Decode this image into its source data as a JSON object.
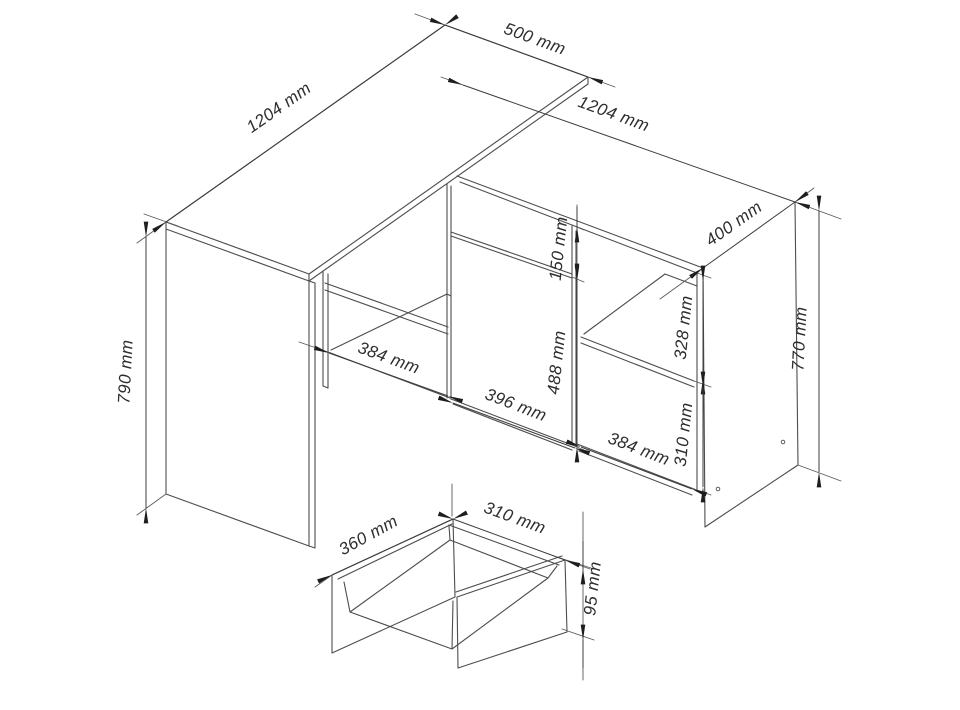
{
  "diagram": {
    "type": "furniture-technical-drawing",
    "background_color": "#ffffff",
    "line_color": "#4d4d4d",
    "text_color": "#2d2d2d",
    "arrow_color": "#1e1e1e",
    "dimensions": {
      "desk_top_length": "1204 mm",
      "desk_top_depth": "500 mm",
      "cabinet_length": "1204 mm",
      "cabinet_depth": "400 mm",
      "desk_height": "790 mm",
      "cabinet_height": "770 mm",
      "left_opening_width": "384 mm",
      "door_width": "396 mm",
      "right_opening_width": "384 mm",
      "drawer_front_height": "150 mm",
      "door_height": "488 mm",
      "upper_shelf_opening_height": "328 mm",
      "lower_shelf_opening_height": "310 mm",
      "drawer_depth": "360 mm",
      "drawer_width": "310 mm",
      "drawer_side_height": "95 mm"
    }
  }
}
